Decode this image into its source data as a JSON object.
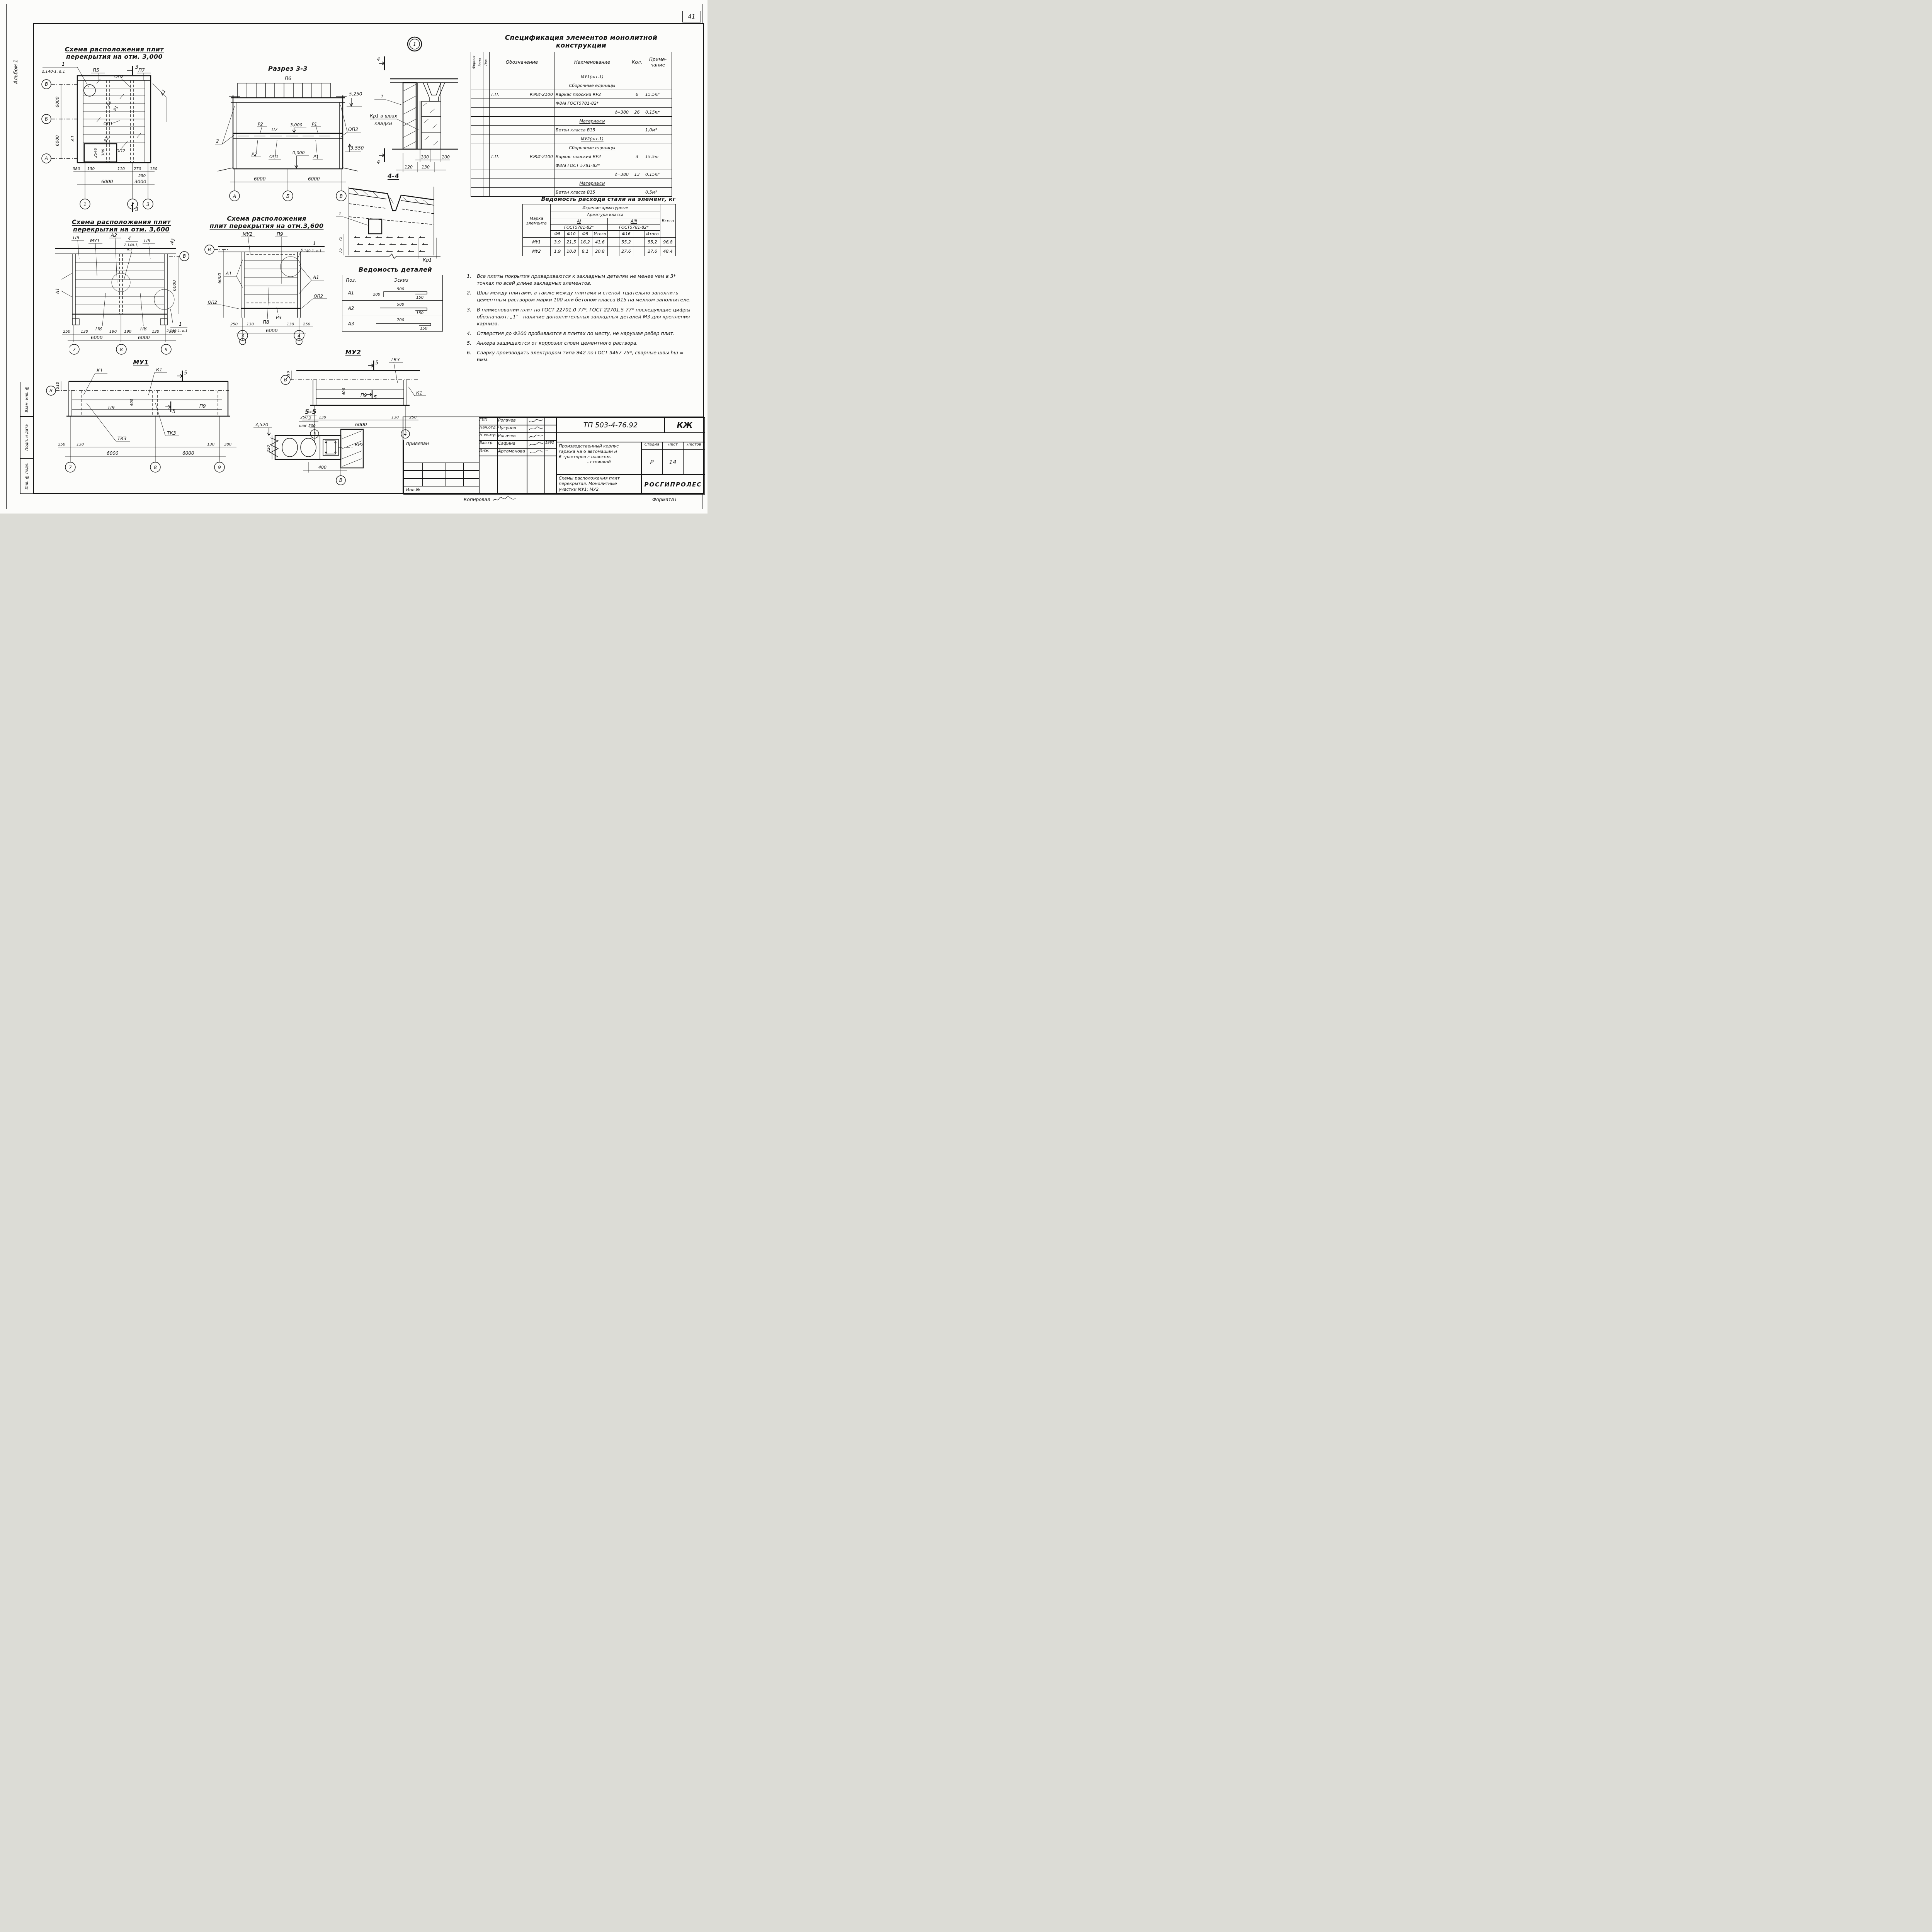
{
  "sheet": {
    "page_number": "41",
    "album_label": "Альбом 1",
    "margin_stamps": {
      "stamp1": "Взам. инв. №",
      "stamp2": "Подп. и дата",
      "stamp3": "Инв. № подл."
    },
    "footer": {
      "copied": "Копировал",
      "format": "ФорматА1"
    }
  },
  "scheme3000": {
    "title1": "Схема расположения плит",
    "title2": "перекрытия на отм. 3,000",
    "callout_num": "1",
    "callout_ref": "2.140-1, в.1",
    "labels": {
      "p5": "П5",
      "p7": "П7",
      "op2a": "ОП2",
      "a3": "А3",
      "r1": "Р1",
      "op1": "ОП1",
      "r2": "Р2",
      "op2b": "ОП2",
      "a1r": "А1",
      "a1l": "А1"
    },
    "axes": {
      "v": "В",
      "b": "Б",
      "a": "А",
      "c1": "1",
      "c2": "2",
      "c3": "3"
    },
    "section": "3",
    "dims": {
      "v1": "6000",
      "v2": "6000",
      "d380": "380",
      "d130a": "130",
      "d110": "110",
      "d270": "270",
      "d130b": "130",
      "d250": "250",
      "d2540": "2540",
      "d380b": "380",
      "b6000": "6000",
      "b3000": "3000"
    }
  },
  "razrez33": {
    "title": "Разрез 3-3",
    "labels": {
      "p6": "П6",
      "r2a": "Р2",
      "p7": "П7",
      "e3000": "3,000",
      "r1a": "Р1",
      "op2": "ОП2",
      "c2": "2",
      "r2b": "Р2",
      "op1": "ОП1",
      "e0": "0,000",
      "r1b": "Р1"
    },
    "elev": {
      "e5250": "5,250",
      "e3550": "3,550"
    },
    "dims": {
      "d1": "6000",
      "d2": "6000"
    },
    "axes": {
      "a": "А",
      "b": "Б",
      "v": "В"
    }
  },
  "node1": {
    "bubble": "1",
    "section": "4",
    "callout": "1",
    "label1": "Кр1 в швах",
    "label2": "кладки",
    "dims": {
      "d100a": "100",
      "d100b": "100",
      "d120": "120",
      "d130": "130"
    }
  },
  "sec44": {
    "title": "4-4",
    "callout": "1",
    "dims": {
      "d75a": "75",
      "d75b": "75"
    },
    "kr1": "Кр1"
  },
  "spec": {
    "title1": "Спецификация элементов монолитной",
    "title2": "конструкции",
    "headers": {
      "format": "Формат",
      "zona": "Зона",
      "poz": "Поз.",
      "oboz": "Обозначение",
      "naim": "Наименование",
      "kol": "Кол.",
      "prim1": "Приме-",
      "prim2": "чание"
    },
    "rows": [
      {
        "naim": "МУ1(шт.1)"
      },
      {
        "naim": "Сборочные единицы"
      },
      {
        "oboz_l": "Т.П.",
        "oboz_r": "КЖИ-2100",
        "naim": "Каркас плоский КР2",
        "kol": "6",
        "prim": "15,5кг"
      },
      {
        "naim": "Ф8АI ГОСТ5781-82*"
      },
      {
        "naim": "ℓ=380",
        "kol": "26",
        "prim": "0,15кг"
      },
      {
        "naim": "Материалы"
      },
      {
        "naim": "Бетон класса В15",
        "prim": "1,0м³"
      },
      {
        "naim": "МУ2(шт.1)"
      },
      {
        "naim": "Сборочные единицы"
      },
      {
        "oboz_l": "Т.П.",
        "oboz_r": "КЖИ-2100",
        "naim": "Каркас плоский КР2",
        "kol": "3",
        "prim": "15,5кг"
      },
      {
        "naim": "Ф8АI ГОСТ 5781-82*"
      },
      {
        "naim": "ℓ=380",
        "kol": "13",
        "prim": "0,15кг"
      },
      {
        "naim": "Материалы"
      },
      {
        "naim": "Бетон класса В15",
        "prim": "0,5м³"
      }
    ]
  },
  "steel": {
    "title": "Ведомость расхода стали на элемент, кг",
    "h_marka1": "Марка",
    "h_marka2": "элемента",
    "h_izdeliya": "Изделия арматурные",
    "h_klass": "Арматура класса",
    "h_ai": "АI",
    "h_aiii": "АIII",
    "h_gost1": "ГОСТ5781-82*",
    "h_gost2": "ГОСТ5781-82*",
    "h_vsego": "Всего",
    "sub": [
      "Ф8",
      "Ф10",
      "Ф8",
      "Итого",
      "",
      "Ф16",
      "",
      "Итого"
    ],
    "rows": [
      {
        "marka": "МУ1",
        "v": [
          "3,9",
          "21,5",
          "16,2",
          "41,6",
          "",
          "55,2",
          "",
          "55,2",
          "96,8"
        ]
      },
      {
        "marka": "МУ2",
        "v": [
          "1,9",
          "10,8",
          "8,1",
          "20,8",
          "",
          "27,6",
          "",
          "27,6",
          "48,4"
        ]
      }
    ]
  },
  "notes": {
    "items": [
      {
        "n": "1.",
        "text": "Все плиты покрытия привариваются к закладным деталям не менее чем в 3* точках по всей длине закладных элементов."
      },
      {
        "n": "2.",
        "text": "Швы между плитами, а также между плитами и стеной тщательно заполнить цементным раствором марки 100 или бетоном класса В15 на мелком заполнителе."
      },
      {
        "n": "3.",
        "text": "В наименовании плит по ГОСТ 22701.0-77*, ГОСТ 22701.5-77* последующие цифры обозначают: „1“ - наличие дополнительных закладных деталей М3 для крепления карниза."
      },
      {
        "n": "4.",
        "text": "Отверстия до Ф200 пробиваются в плитах по месту, не нарушая ребер плит."
      },
      {
        "n": "5.",
        "text": "Анкера защищаются от коррозии слоем цементного раствора."
      },
      {
        "n": "6.",
        "text": "Сварку производить электродом типа Э42 по ГОСТ 9467-75*, сварные швы hш = 6мм."
      }
    ]
  },
  "scheme3600L": {
    "title1": "Схема расположения плит",
    "title2": "перекрытия на отм. 3,600",
    "labels": {
      "p9a": "П9",
      "mu1": "МУ1",
      "a2": "А2",
      "c4": "4",
      "ref4a": "2.140-1,",
      "ref4b": "в.1",
      "p9b": "П9",
      "a1r": "А1",
      "a1l": "А1",
      "p8a": "П8",
      "p8b": "П8"
    },
    "callout1": "1",
    "ref1": "2.140-1, в.1",
    "dims": {
      "d250": "250",
      "d130a": "130",
      "d190a": "190",
      "d190b": "190",
      "d130b": "130",
      "d380": "380",
      "b1": "6000",
      "b2": "6000",
      "v1": "6000"
    },
    "axes": {
      "a7": "7",
      "a8": "8",
      "a9": "9",
      "v": "В"
    }
  },
  "scheme3600R": {
    "title1": "Схема расположения",
    "title2": "плит перекрытия на отм.3,600",
    "labels": {
      "mu2": "МУ2",
      "p9": "П9",
      "a1l": "А1",
      "a1r": "А1",
      "op2l": "ОП2",
      "op2r": "ОП2",
      "p8": "П8",
      "r3": "Р3"
    },
    "callout1": "1",
    "ref1": "2.140-1, в.1",
    "dims": {
      "d250a": "250",
      "d130a": "130",
      "d130b": "130",
      "d250b": "250",
      "b1": "6000",
      "v1": "6000"
    },
    "axes": {
      "a3": "3",
      "a4": "4",
      "v": "В"
    }
  },
  "vedomost": {
    "title": "Ведомость деталей",
    "h_poz": "Поз.",
    "h_eskiz": "Эскиз",
    "rows": [
      {
        "poz": "А1",
        "d1": "200",
        "d2": "500",
        "d3": "150"
      },
      {
        "poz": "А2",
        "d2": "500",
        "d3": "150"
      },
      {
        "poz": "А3",
        "d2": "700",
        "d3": "150"
      }
    ]
  },
  "mu1": {
    "title": "МУ1",
    "labels": {
      "k1a": "К1",
      "k1b": "К1",
      "p9a": "П9",
      "p9b": "П9",
      "tk3a": "ТК3",
      "tk3b": "ТК3",
      "s5a": "5",
      "s5b": "5"
    },
    "dims": {
      "d510": "510",
      "d400": "400",
      "d250": "250",
      "d130a": "130",
      "d130b": "130",
      "d380": "380",
      "b1": "6000",
      "b2": "6000"
    },
    "axes": {
      "a7": "7",
      "a8": "8",
      "a9": "9",
      "v": "В"
    }
  },
  "mu2": {
    "title": "МУ2",
    "labels": {
      "tk3": "ТК3",
      "k1": "К1",
      "p9": "П9",
      "s5a": "5",
      "s5b": "5"
    },
    "dims": {
      "d510": "510",
      "d400": "400",
      "d250a": "250",
      "d130a": "130",
      "d130b": "130",
      "d250b": "250",
      "b1": "6000"
    },
    "axes": {
      "a3": "3",
      "a4": "4",
      "v": "В"
    }
  },
  "sec55": {
    "title": "5-5",
    "elev": "3,520",
    "callout_n": "2",
    "callout_t": "шаг 500",
    "d220": "220",
    "d400": "400",
    "kr2": "КР2",
    "axis_v": "В"
  },
  "titleblock": {
    "sign_rows": [
      {
        "role": "ГИП",
        "name": "Рогачев",
        "date": ""
      },
      {
        "role": "Нач.отд.",
        "name": "Чугунов",
        "date": ""
      },
      {
        "role": "Н.контр.",
        "name": "Рогачев",
        "date": ""
      },
      {
        "role": "Зав.гр.",
        "name": "Сафина",
        "date": "1992"
      },
      {
        "role": "Инж.",
        "name": "Артамонова",
        "date": "~"
      }
    ],
    "doc": "ТП 503-4-76.92",
    "type": "КЖ",
    "project1": "Производственный корпус",
    "project2": "гаража на 6 автомашин и",
    "project3": "6 тракторов с навесом-",
    "project4": "- стоянкой",
    "stage_l": "Стадия",
    "sheet_l": "Лист",
    "sheets_l": "Листов",
    "stage": "Р",
    "sheet": "14",
    "sheets": "",
    "title1": "Схемы расположения плит",
    "title2": "перекрытия. Монолитные",
    "title3": "участки МУ1; МУ2.",
    "org": "РОСГИПРОЛЕС",
    "binding": "привязан",
    "inv": "Инв.№"
  }
}
